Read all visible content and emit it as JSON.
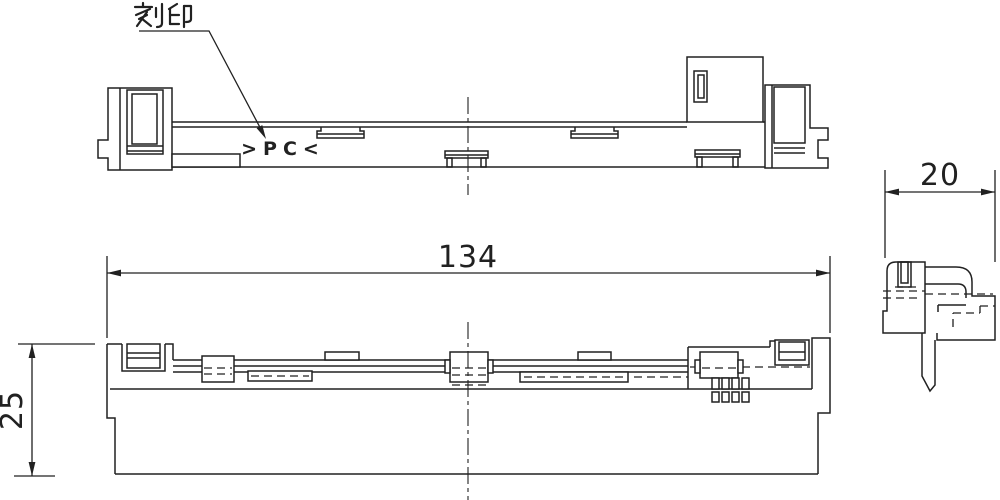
{
  "canvas": {
    "background": "#ffffff",
    "ink": "#212121"
  },
  "annotations": {
    "engraving_label": "刻印",
    "engraving_mark": ">PC<"
  },
  "dimensions": {
    "length": "134",
    "height": "25",
    "depth": "20"
  }
}
